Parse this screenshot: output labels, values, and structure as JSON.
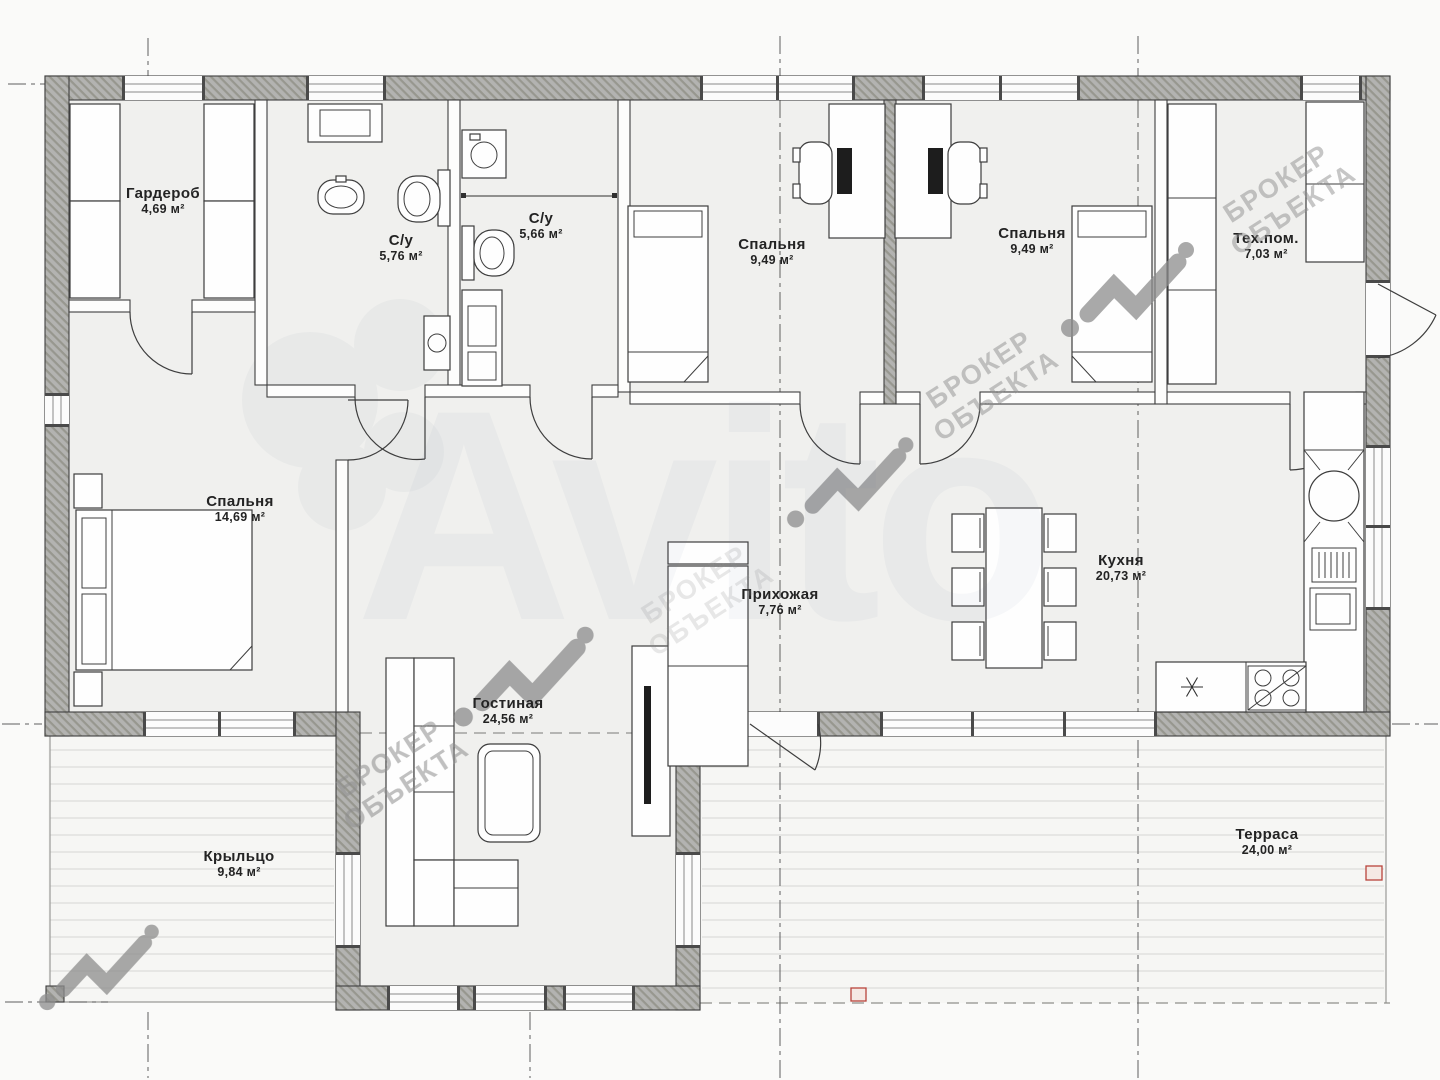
{
  "plan": {
    "title": "Поэтажный план одноэтажного дома",
    "rooms": [
      {
        "id": "wardrobe",
        "name": "Гардероб",
        "area": "4,69 м²"
      },
      {
        "id": "bathroom-1",
        "name": "С/у",
        "area": "5,76 м²"
      },
      {
        "id": "bathroom-2",
        "name": "С/у",
        "area": "5,66 м²"
      },
      {
        "id": "bedroom-1",
        "name": "Спальня",
        "area": "9,49 м²"
      },
      {
        "id": "bedroom-2",
        "name": "Спальня",
        "area": "9,49 м²"
      },
      {
        "id": "tech-room",
        "name": "Тех.пом.",
        "area": "7,03 м²"
      },
      {
        "id": "bedroom-main",
        "name": "Спальня",
        "area": "14,69 м²"
      },
      {
        "id": "hallway",
        "name": "Прихожая",
        "area": "7,76 м²"
      },
      {
        "id": "living-room",
        "name": "Гостиная",
        "area": "24,56 м²"
      },
      {
        "id": "kitchen",
        "name": "Кухня",
        "area": "20,73 м²"
      },
      {
        "id": "porch",
        "name": "Крыльцо",
        "area": "9,84 м²"
      },
      {
        "id": "terrace",
        "name": "Терраса",
        "area": "24,00 м²"
      }
    ]
  },
  "watermark": {
    "line1": "БРОКЕР",
    "line2": "ОБЪЕКТА",
    "logo_text": "Avito"
  },
  "colors": {
    "paper": "#fafaf9",
    "floor": "#f0f0ee",
    "deck": "#f6f6f4",
    "deck_line": "#d6d6d3",
    "wall_fill": "#b3b3b1",
    "wall_hatch": "#97978f",
    "wall_stroke": "#3f3f3f",
    "partition": "#fdfdfc",
    "line": "#3d3d3d",
    "axis": "#5f5f5f",
    "watermark": "#8d8d8d",
    "accent_red": "#b8443c",
    "avito": "#6b7f94"
  }
}
